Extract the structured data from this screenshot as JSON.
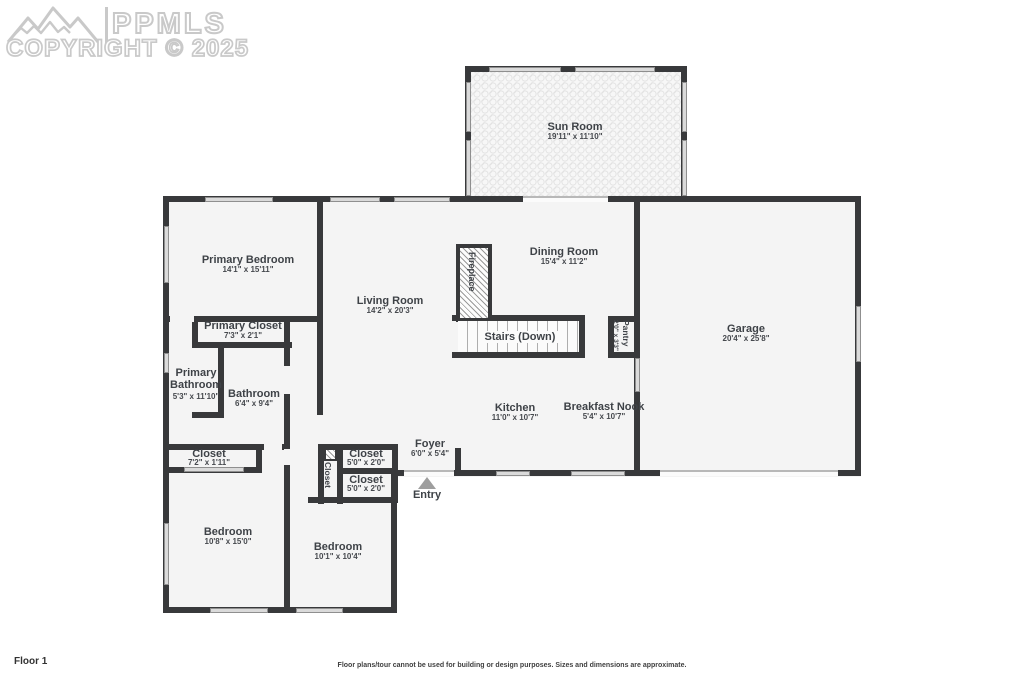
{
  "watermark": {
    "brand": "PPMLS",
    "copyright_line": "COPYRIGHT © 2025",
    "icon": "mountains-logo"
  },
  "footer": {
    "floor_label": "Floor 1",
    "disclaimer": "Floor plans/tour cannot be used for building or design purposes. Sizes and dimensions are approximate."
  },
  "colors": {
    "wall": "#38393b",
    "room_fill": "#f4f4f4",
    "window": "#dadada",
    "label_text": "#3e4247",
    "watermark_outline": "#c9c9c9",
    "entry_arrow": "#9e9e9e"
  },
  "rooms": {
    "sun_room": {
      "name": "Sun Room",
      "dims": "19'11\" x 11'10\""
    },
    "primary_bedroom": {
      "name": "Primary Bedroom",
      "dims": "14'1\" x 15'11\""
    },
    "living_room": {
      "name": "Living Room",
      "dims": "14'2\" x 20'3\""
    },
    "dining_room": {
      "name": "Dining Room",
      "dims": "15'4\" x 11'2\""
    },
    "garage": {
      "name": "Garage",
      "dims": "20'4\" x 25'8\""
    },
    "primary_closet": {
      "name": "Primary Closet",
      "dims": "7'3\" x 2'1\""
    },
    "primary_bathroom": {
      "name": "Primary Bathroom",
      "dims": "5'3\" x 11'10\""
    },
    "bathroom": {
      "name": "Bathroom",
      "dims": "6'4\" x 9'4\""
    },
    "kitchen": {
      "name": "Kitchen",
      "dims": "11'0\" x 10'7\""
    },
    "breakfast_nook": {
      "name": "Breakfast Nook",
      "dims": "5'4\" x 10'7\""
    },
    "foyer": {
      "name": "Foyer",
      "dims": "6'0\" x 5'4\""
    },
    "hall_closet": {
      "name": "Closet",
      "dims": "7'2\" x 1'11\""
    },
    "closet_upper": {
      "name": "Closet",
      "dims": "5'0\" x 2'0\""
    },
    "closet_lower": {
      "name": "Closet",
      "dims": "5'0\" x 2'0\""
    },
    "closet_vertical": {
      "name": "Closet"
    },
    "bedroom_1": {
      "name": "Bedroom",
      "dims": "10'8\" x 15'0\""
    },
    "bedroom_2": {
      "name": "Bedroom",
      "dims": "10'1\" x 10'4\""
    }
  },
  "features": {
    "fireplace": {
      "label": "Fireplace"
    },
    "stairs": {
      "label": "Stairs (Down)"
    },
    "pantry": {
      "label": "Pantry",
      "dims": "2'0\" x 3'3\""
    },
    "entry": {
      "label": "Entry",
      "arrow": "up-triangle"
    }
  }
}
